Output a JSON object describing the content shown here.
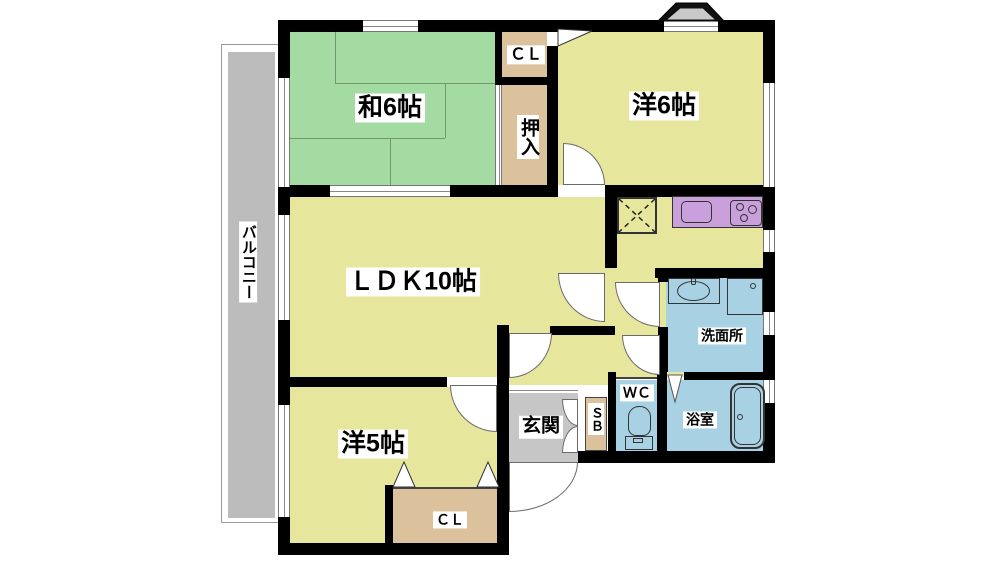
{
  "plan_title": "apartment floor plan",
  "rooms": {
    "japanese_room": {
      "label": "和6帖"
    },
    "western_room_6": {
      "label": "洋6帖"
    },
    "living_dining_kitchen": {
      "label": "ＬＤＫ10帖"
    },
    "western_room_5": {
      "label": "洋5帖"
    },
    "closet_upper": {
      "label": "ＣＬ"
    },
    "oshiire_closet": {
      "label": "押入"
    },
    "closet_lower": {
      "label": "ＣＬ"
    },
    "entrance": {
      "label": "玄関"
    },
    "shoe_box": {
      "label": "ＳＢ"
    },
    "toilet_room": {
      "label": "ＷＣ"
    },
    "washroom": {
      "label": "洗面所"
    },
    "bathroom": {
      "label": "浴室"
    },
    "balcony": {
      "label": "バルコニー"
    }
  },
  "fixtures": {
    "kitchen_counter": "kitchen counter with sink and 3-burner stove",
    "refrigerator_space": "refrigerator space (dashed X box)",
    "washbasin": "washbasin",
    "washing_machine": "washing machine space",
    "toilet": "toilet",
    "bathtub": "bathtub",
    "bay_window": "bay window"
  },
  "colors": {
    "tatami_green": "#a3dba3",
    "room_yellow": "#e6e69c",
    "closet_tan": "#dcc19d",
    "kitchen_purple": "#caa0dc",
    "wet_blue": "#a8d2e4",
    "entrance_gray": "#c6c6c6",
    "balcony_gray": "#bcbcbc",
    "wall_black": "#000000"
  }
}
